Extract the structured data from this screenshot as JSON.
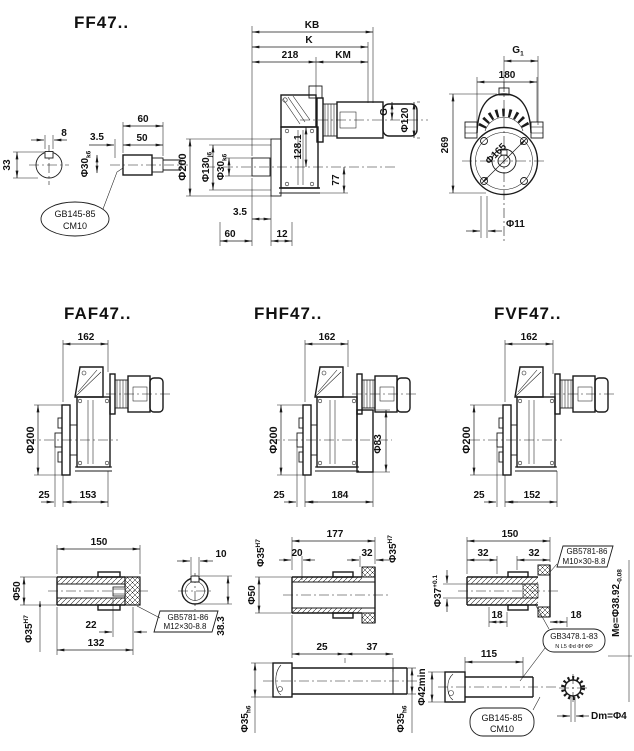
{
  "ff47": {
    "title": "FF47..",
    "end_view": {
      "d8": "8",
      "d33": "33"
    },
    "sleeve": {
      "d60": "60",
      "d50": "50",
      "d3_5": "3.5",
      "phi30": "Φ30",
      "phi30_tol": "k6"
    },
    "callout": {
      "l1": "GB145-85",
      "l2": "CM10"
    },
    "side": {
      "kb": "KB",
      "k": "K",
      "d218": "218",
      "km": "KM",
      "phi200": "Φ200",
      "phi130": "Φ130",
      "phi130_tol": "j6",
      "phi30": "Φ30",
      "phi30_tol": "k6",
      "d128": "128.1",
      "d77": "77",
      "g": "G",
      "phi120": "Φ120",
      "d3_5": "3.5",
      "d60": "60",
      "d12": "12"
    },
    "front": {
      "g1": "G",
      "g1_sub": "1",
      "d180": "180",
      "d269": "269",
      "phi165": "Φ165",
      "phi11": "Φ11"
    }
  },
  "faf47": {
    "title": "FAF47..",
    "d162": "162",
    "phi200": "Φ200",
    "d25": "25",
    "d153": "153"
  },
  "fhf47": {
    "title": "FHF47..",
    "d162": "162",
    "phi200": "Φ200",
    "phi83": "Φ83",
    "d25": "25",
    "d184": "184"
  },
  "fvf47": {
    "title": "FVF47..",
    "d162": "162",
    "phi200": "Φ200",
    "d25": "25",
    "d152": "152"
  },
  "hollow_shaft": {
    "d150": "150",
    "phi50": "Φ50",
    "phi35": "Φ35",
    "phi35_tol": "H7",
    "d22": "22",
    "d132": "132",
    "bolt": {
      "l1": "GB5781-86",
      "l2": "M12×30-8.8"
    },
    "d10": "10",
    "d38_3": "38.3"
  },
  "stepped_shaft": {
    "d177": "177",
    "phi35_l": "Φ35",
    "phi35_l_tol": "H7",
    "d20": "20",
    "d32": "32",
    "phi35_r": "Φ35",
    "phi35_r_tol": "H7",
    "phi50": "Φ50",
    "d25": "25",
    "d37": "37",
    "phi35_a": "Φ35",
    "phi35_a_tol": "h6",
    "phi35_b": "Φ35",
    "phi35_b_tol": "h6",
    "phi42": "Φ42min"
  },
  "spline_shaft": {
    "d150": "150",
    "d32a": "32",
    "d32b": "32",
    "phi37": "Φ37",
    "phi37_tol": "+0.1",
    "bolt": {
      "l1": "GB5781-86",
      "l2": "M10×30-8.8"
    },
    "d18a": "18",
    "d18b": "18",
    "spline": {
      "l1": "GB3478.1-83",
      "l2": "N  L5  Φd Φf ΦP"
    },
    "d115": "115",
    "center": {
      "l1": "GB145-85",
      "l2": "CM10"
    },
    "me": "Me=Φ38.92",
    "me_tol": "-0.08",
    "dm": "Dm=Φ4"
  }
}
